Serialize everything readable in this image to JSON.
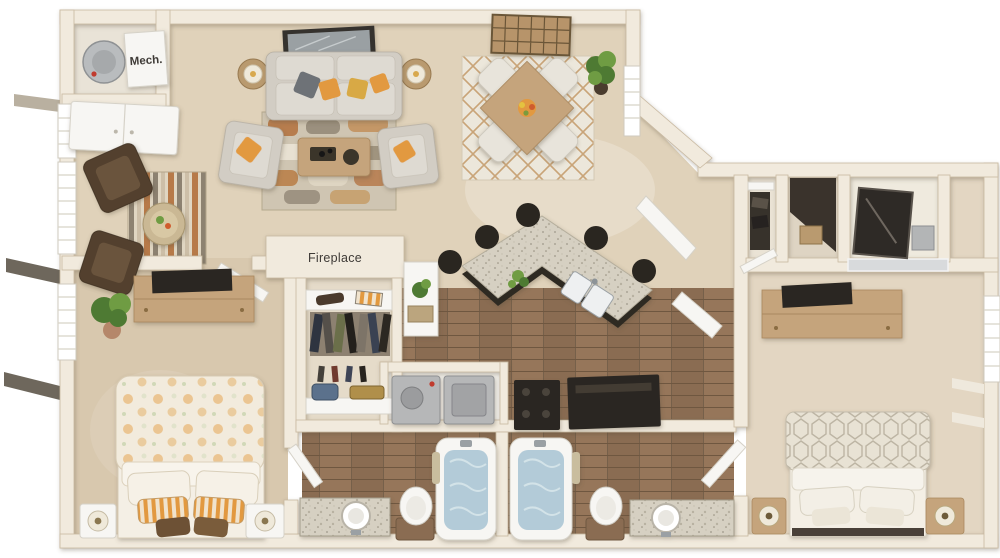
{
  "labels": {
    "mech": "Mech.",
    "fireplace": "Fireplace"
  },
  "colors": {
    "wall": "#f1eadd",
    "wall_edge": "#c9b9a1",
    "wall_face": "#ddcfb9",
    "carpet": "#e0d2ba",
    "carpet_bed1": "#d8c8ae",
    "carpet_bed2": "#e3d6c2",
    "wood": "#8a6c52",
    "wood_dark": "#6f5740",
    "wood_light": "#99795b",
    "granite": "#d6d0c2",
    "granite_dot": "#a9a293",
    "island_base": "#2e2923",
    "water": "#b3cbd8",
    "fixture": "#f7f6f3",
    "sofa": "#d2cdc4",
    "cushion": "#dedad2",
    "orange": "#e2993f",
    "gray_pillow": "#6e7277",
    "rug_rust": "#b06a34",
    "rug_tan": "#cdbfa8",
    "rug_cream": "#e8e1d2",
    "table_wood": "#c5a47c",
    "chair_white": "#e8e4db",
    "chair_brown": "#53402e",
    "plant": "#4e7a33",
    "plant_light": "#6f9c43",
    "dark": "#2a2620",
    "appliance": "#b6b7b8",
    "bed_white": "#f4efe5",
    "mirror": "#d8dadc",
    "label": "#3e3a36"
  }
}
